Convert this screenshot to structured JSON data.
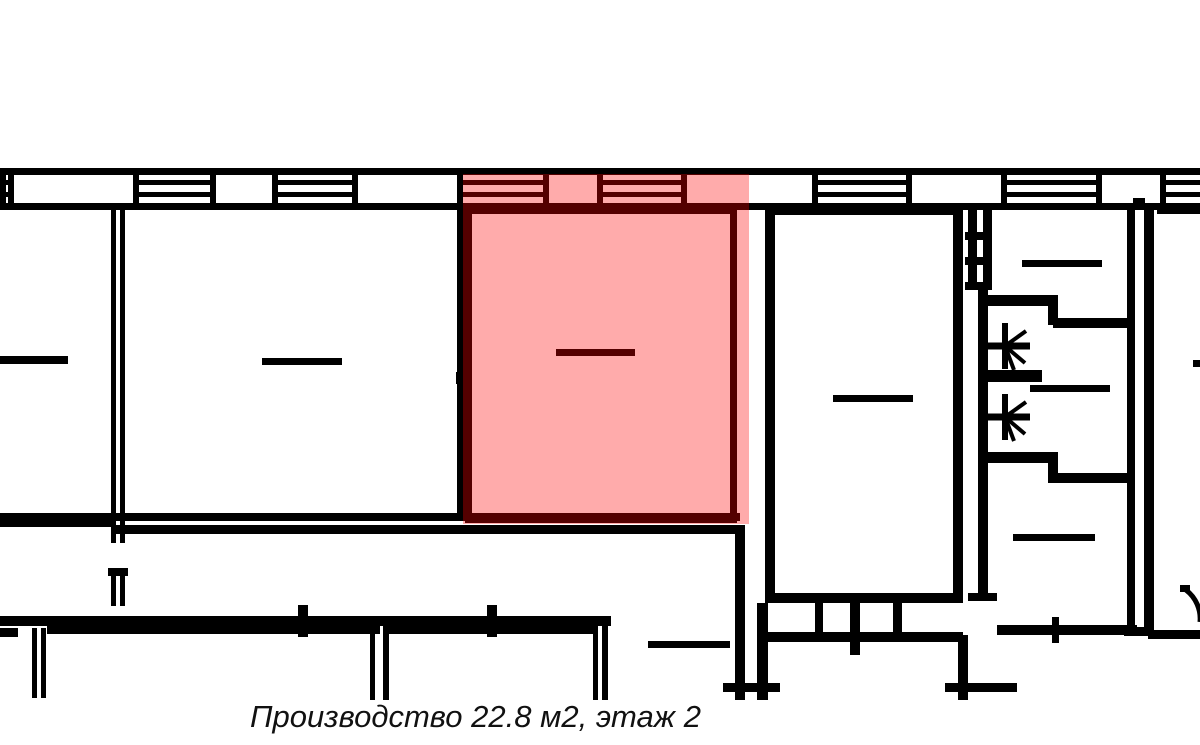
{
  "canvas": {
    "width": 1200,
    "height": 745
  },
  "colors": {
    "background": "#ffffff",
    "wall": "#000000",
    "highlight": "rgba(255,0,0,0.33)",
    "caption": "#111111"
  },
  "caption": {
    "text": "Производство 22.8 м2, этаж 2"
  },
  "highlight": {
    "x": 463,
    "y": 174,
    "width": 286,
    "height": 350,
    "label": "Производство 22.8 м2"
  },
  "plan": {
    "wall_band": {
      "top_line": [
        0,
        168,
        1200,
        7
      ],
      "bottom_line": [
        0,
        203,
        1200,
        7
      ],
      "band_y": 168,
      "band_h": 42,
      "divider_w": 6,
      "dividers": [
        0,
        8,
        133,
        210,
        272,
        352,
        457,
        543,
        597,
        681,
        812,
        906,
        1001,
        1096,
        1160
      ],
      "windows": [
        [
          0,
          8
        ],
        [
          138,
          210
        ],
        [
          277,
          352
        ],
        [
          463,
          543
        ],
        [
          602,
          681
        ],
        [
          818,
          912
        ],
        [
          1007,
          1102
        ],
        [
          1165,
          1200
        ]
      ],
      "window_line_ys": [
        180,
        192
      ],
      "window_line_h": 5
    },
    "walls": [
      [
        111,
        208,
        5,
        335
      ],
      [
        120,
        208,
        5,
        335
      ],
      [
        108,
        568,
        20,
        8
      ],
      [
        111,
        576,
        5,
        30
      ],
      [
        120,
        576,
        5,
        30
      ],
      [
        0,
        513,
        740,
        8
      ],
      [
        0,
        515,
        111,
        12
      ],
      [
        111,
        525,
        634,
        9
      ],
      [
        457,
        208,
        9,
        305
      ],
      [
        456,
        372,
        10,
        12
      ],
      [
        465,
        206,
        272,
        8
      ],
      [
        465,
        206,
        7,
        317
      ],
      [
        730,
        206,
        7,
        317
      ],
      [
        465,
        515,
        272,
        8
      ],
      [
        735,
        525,
        10,
        175
      ],
      [
        757,
        603,
        11,
        97
      ],
      [
        723,
        683,
        57,
        9
      ],
      [
        765,
        205,
        10,
        398
      ],
      [
        765,
        205,
        198,
        10
      ],
      [
        953,
        205,
        10,
        398
      ],
      [
        765,
        593,
        198,
        10
      ],
      [
        815,
        603,
        8,
        30
      ],
      [
        850,
        593,
        10,
        62
      ],
      [
        893,
        603,
        9,
        30
      ],
      [
        763,
        632,
        200,
        10
      ],
      [
        968,
        205,
        9,
        85
      ],
      [
        983,
        205,
        9,
        85
      ],
      [
        965,
        232,
        27,
        8
      ],
      [
        965,
        257,
        27,
        8
      ],
      [
        965,
        282,
        27,
        8
      ],
      [
        978,
        290,
        10,
        311
      ],
      [
        968,
        593,
        29,
        8
      ],
      [
        1127,
        207,
        8,
        428
      ],
      [
        1144,
        205,
        10,
        430
      ],
      [
        1124,
        627,
        30,
        9
      ],
      [
        1148,
        630,
        52,
        9
      ],
      [
        988,
        295,
        70,
        11
      ],
      [
        1048,
        295,
        10,
        30
      ],
      [
        1053,
        318,
        82,
        10
      ],
      [
        988,
        370,
        54,
        12
      ],
      [
        988,
        452,
        69,
        11
      ],
      [
        1048,
        452,
        10,
        31
      ],
      [
        1053,
        473,
        82,
        10
      ],
      [
        1157,
        205,
        43,
        9
      ],
      [
        1133,
        198,
        12,
        10
      ],
      [
        0,
        616,
        611,
        10
      ],
      [
        298,
        605,
        10,
        32
      ],
      [
        487,
        605,
        10,
        32
      ],
      [
        47,
        626,
        333,
        8
      ],
      [
        386,
        626,
        211,
        8
      ],
      [
        370,
        626,
        5,
        74
      ],
      [
        383,
        626,
        6,
        74
      ],
      [
        593,
        626,
        5,
        74
      ],
      [
        602,
        616,
        6,
        84
      ],
      [
        0,
        628,
        18,
        9
      ],
      [
        32,
        628,
        5,
        70
      ],
      [
        41,
        628,
        5,
        70
      ],
      [
        997,
        625,
        140,
        10
      ],
      [
        1052,
        617,
        7,
        26
      ],
      [
        945,
        683,
        72,
        9
      ],
      [
        958,
        635,
        10,
        65
      ],
      [
        1180,
        585,
        10,
        7
      ]
    ],
    "marks": [
      [
        0,
        356,
        68,
        8
      ],
      [
        262,
        358,
        80,
        7
      ],
      [
        556,
        349,
        79,
        7
      ],
      [
        833,
        395,
        80,
        7
      ],
      [
        1022,
        260,
        80,
        7
      ],
      [
        1030,
        385,
        80,
        7
      ],
      [
        1013,
        534,
        82,
        7
      ],
      [
        1193,
        360,
        7,
        7
      ],
      [
        648,
        641,
        82,
        7
      ]
    ],
    "stars": [
      {
        "cx": 1005,
        "cy": 346
      },
      {
        "cx": 1005,
        "cy": 417
      }
    ],
    "star_geometry": {
      "bar_left": 20,
      "bar_right": 25,
      "bar_w": 7,
      "vert_half": 23,
      "vert_w": 6,
      "rays": [
        [
          21,
          -15
        ],
        [
          20,
          17
        ],
        [
          9,
          24
        ]
      ],
      "ray_w": 4
    },
    "door_arc": {
      "d": "M 1186 590 A 36 36 0 0 1 1200 622",
      "stroke_w": 5
    }
  }
}
